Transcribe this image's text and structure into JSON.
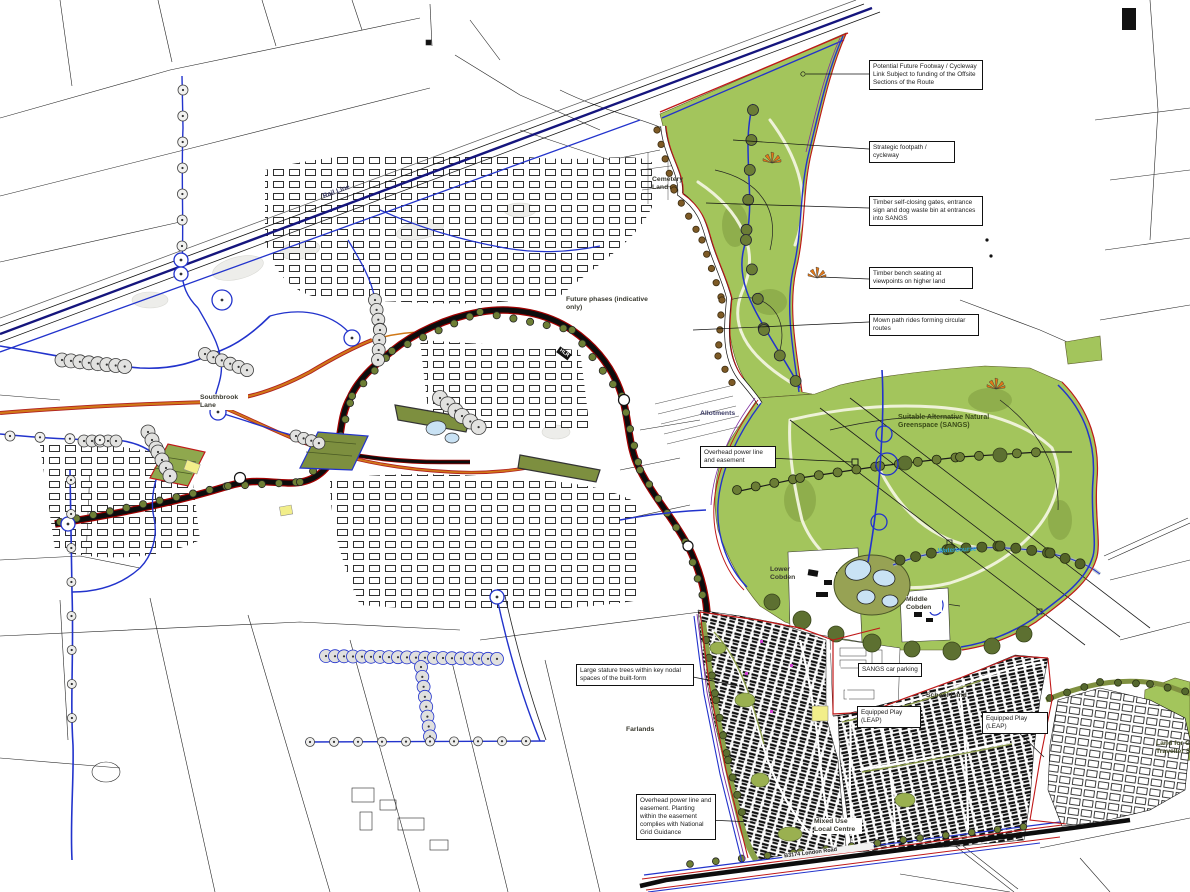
{
  "map": {
    "title": "Development framework masterplan with SANGS",
    "colors": {
      "sangs_green": "#a3c55c",
      "path_blue": "#2233cc",
      "boundary_red": "#c01818",
      "boundary_purple": "#8030a0",
      "lane_orange": "#d07818",
      "rail_navy": "#15157d"
    },
    "callouts": {
      "future_footway": "Potential Future Footway / Cycleway Link Subject to funding of the Offsite Sections of the Route",
      "strategic_footpath": "Strategic footpath / cycleway",
      "timber_gates": "Timber self-closing gates, entrance sign and dog waste bin at entrances into SANGS",
      "timber_bench": "Timber bench seating at viewpoints on higher land",
      "mown_paths": "Mown path rides forming circular routes",
      "overhead_easement": "Overhead power line and easement",
      "large_trees": "Large stature trees within key nodal spaces of the built-form",
      "overhead_guidance": "Overhead power line and easement. Planting within the easement complies with National Grid Guidance",
      "sangs_parking": "SANGS car parking",
      "leap_west": "Equipped Play (LEAP)",
      "leap_east": "Equipped Play (LEAP)"
    },
    "labels": {
      "rail_line": "Rail Line",
      "cemetery": "Cemetery Land",
      "future_phases": "Future phases (indicative only)",
      "southbrook": "Southbrook Lane",
      "allotments": "Allotments",
      "sangs": "Suitable Alternative Natural Greenspace (SANGS)",
      "watercourse": "Watercourse",
      "hlr": "HLR",
      "farlands": "Farlands",
      "lower_cobden": "Lower Cobden",
      "middle_cobden": "Middle Cobden",
      "school_land": "School Land",
      "mixed_use": "Mixed Use Local Centre",
      "london_road": "B3174 London Road",
      "traveller_land": "Land for G Traveller S"
    }
  }
}
